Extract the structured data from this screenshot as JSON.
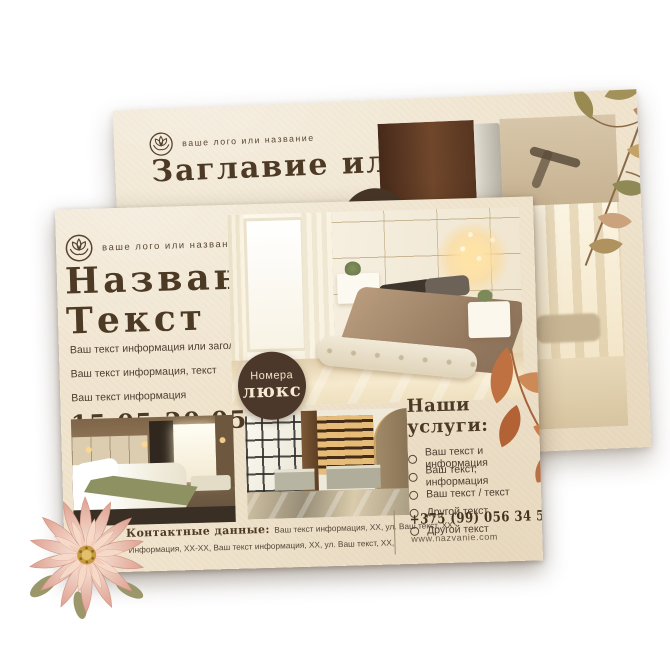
{
  "colors": {
    "paper": "#f0e4ce",
    "ink_brown": "#4d3a25",
    "badge_brown": "#4b382a",
    "terracotta_leaf": "#c07142",
    "dahlia_pink": "#e8b09c"
  },
  "back_flyer": {
    "logo_icon": "lotus-flower-icon",
    "logo_text": "ваше лого или название",
    "title": "Заглавие или"
  },
  "front_flyer": {
    "logo_icon": "lotus-flower-icon",
    "logo_text": "ваше лого или название",
    "title_line1": "Название",
    "title_line2": "Текст",
    "body_lines": [
      "Ваш текст информация или заголовок.",
      "Ваш текст информация, текст",
      "Ваш текст информация"
    ],
    "dates": "15.05-20.05",
    "badge": {
      "line1": "Номера",
      "line2": "люкс"
    },
    "services": {
      "title": "Наши услуги:",
      "items": [
        "Ваш текст и информация",
        "Ваш текст, информация",
        "Ваш текст / текст",
        "Другой текст",
        "Другой текст"
      ]
    },
    "contacts": {
      "label": "Контактные данные:",
      "line1": "Ваш текст информация, XX, ул. Ваш текст, XX",
      "line2": "Информация, XX-XX, Ваш текст информация, XX, ул. Ваш текст, XX,",
      "phone": "+375 (99) 056 34 56",
      "website": "www.nazvanie.com"
    },
    "decorations": [
      "dahlia-flower",
      "terracotta-leaf-branch"
    ],
    "photos": [
      "luxury-bedroom",
      "hotel-room",
      "hotel-lobby"
    ]
  }
}
